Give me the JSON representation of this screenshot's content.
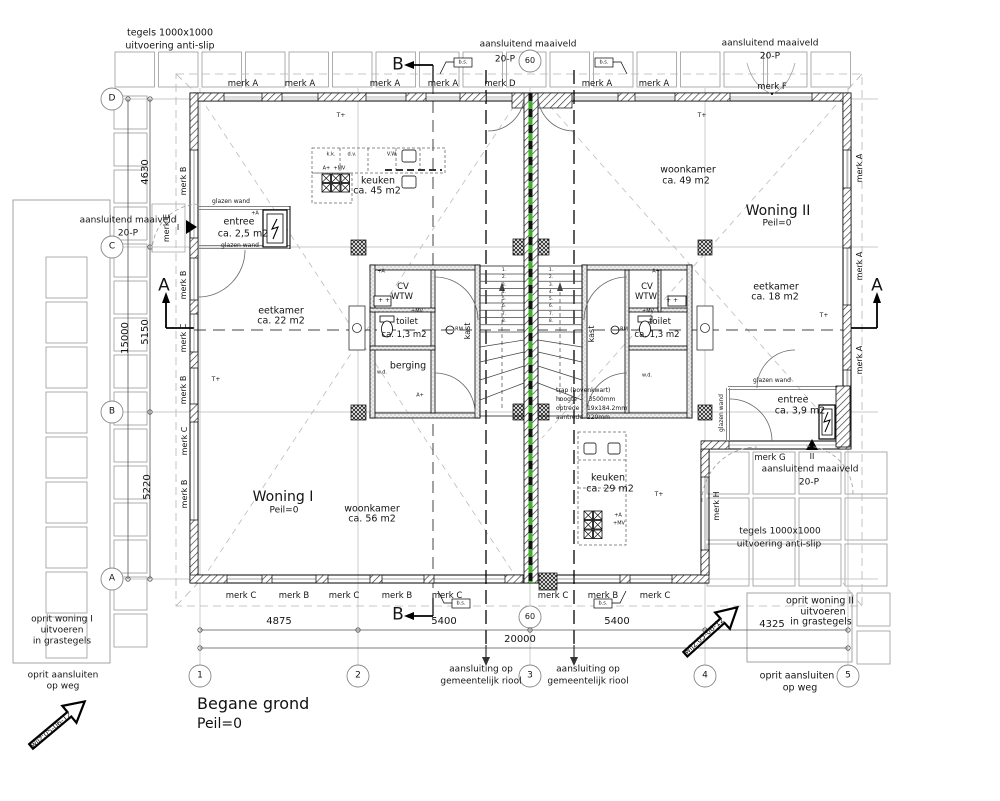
{
  "drawing_title": {
    "name": "Begane grond",
    "level": "Peil=0"
  },
  "colors": {
    "party_wall_green": "#3fae2a",
    "line": "#000000",
    "tile_gray": "#9a9a9a"
  },
  "grid_axes": {
    "columns": [
      {
        "label": "1",
        "x": 200
      },
      {
        "label": "2",
        "x": 358
      },
      {
        "label": "3",
        "x": 530
      },
      {
        "label": "4",
        "x": 705
      },
      {
        "label": "5",
        "x": 848
      }
    ],
    "rows": [
      {
        "label": "D",
        "y": 99
      },
      {
        "label": "C",
        "y": 247
      },
      {
        "label": "B",
        "y": 412
      },
      {
        "label": "A",
        "y": 579
      }
    ]
  },
  "stair_numbers": [
    "1.",
    "2.",
    "3.",
    "4.",
    "5.",
    "6.",
    "7.",
    "8."
  ],
  "labels": [
    {
      "i": "tegels-top-line1",
      "t": "tegels 1000x1000",
      "x": 170,
      "y": 33,
      "s": 9.5
    },
    {
      "i": "tegels-top-line2",
      "t": "uitvoering anti-slip",
      "x": 170,
      "y": 46,
      "s": 9.5
    },
    {
      "i": "maaiveld-top-line1",
      "t": "aansluitend maaiveld",
      "x": 528,
      "y": 45,
      "s": 9
    },
    {
      "i": "maaiveld-top-line2",
      "t": "20-P",
      "x": 505,
      "y": 60,
      "s": 9
    },
    {
      "i": "level-circle-top",
      "t": "60",
      "x": 530,
      "y": 61,
      "s": 8
    },
    {
      "i": "merk-d-label",
      "t": "merk D",
      "x": 500,
      "y": 84,
      "s": 8.5
    },
    {
      "i": "maaiveld-topright-line1",
      "t": "aansluitend maaiveld",
      "x": 770,
      "y": 44,
      "s": 9
    },
    {
      "i": "maaiveld-topright-line2",
      "t": "20-P",
      "x": 770,
      "y": 57,
      "s": 9
    },
    {
      "i": "merk-f-label",
      "t": "merk F",
      "x": 772,
      "y": 87,
      "s": 8.5
    },
    {
      "i": "merk-a-top-1",
      "t": "merk A",
      "x": 243,
      "y": 84,
      "s": 8.5
    },
    {
      "i": "merk-a-top-2",
      "t": "merk A",
      "x": 300,
      "y": 84,
      "s": 8.5
    },
    {
      "i": "merk-a-top-3",
      "t": "merk A",
      "x": 385,
      "y": 84,
      "s": 8.5
    },
    {
      "i": "merk-a-top-4",
      "t": "merk A",
      "x": 443,
      "y": 84,
      "s": 8.5
    },
    {
      "i": "merk-a-top-5",
      "t": "merk A",
      "x": 597,
      "y": 84,
      "s": 8.5
    },
    {
      "i": "merk-a-top-6",
      "t": "merk A",
      "x": 654,
      "y": 84,
      "s": 8.5
    },
    {
      "i": "maaiveld-left-line1",
      "t": "aansluitend maaiveld",
      "x": 128,
      "y": 221,
      "s": 9
    },
    {
      "i": "maaiveld-left-line2",
      "t": "20-P",
      "x": 128,
      "y": 234,
      "s": 9
    },
    {
      "i": "merk-e-label",
      "t": "merk E",
      "x": 167,
      "y": 228,
      "s": 8,
      "r": -90
    },
    {
      "i": "entrance-mark-1",
      "t": "I",
      "x": 178,
      "y": 228,
      "s": 8
    },
    {
      "i": "glazen-wand-1",
      "t": "glazen wand",
      "x": 231,
      "y": 202,
      "s": 6
    },
    {
      "i": "entree1-line1",
      "t": "entree",
      "x": 239,
      "y": 222,
      "s": 9.5
    },
    {
      "i": "entree1-line2",
      "t": "ca. 2,5 m2",
      "x": 243,
      "y": 234,
      "s": 9.5
    },
    {
      "i": "glazen-wand-2",
      "t": "glazen wand",
      "x": 240,
      "y": 246,
      "s": 6
    },
    {
      "i": "keuken1-line1",
      "t": "keuken",
      "x": 378,
      "y": 181,
      "s": 9.5
    },
    {
      "i": "keuken1-line2",
      "t": "ca. 45 m2",
      "x": 377,
      "y": 191,
      "s": 9.5
    },
    {
      "i": "kitchen1-kk",
      "t": "k.k.",
      "x": 331,
      "y": 155,
      "s": 5
    },
    {
      "i": "kitchen1-dv",
      "t": "d.v.",
      "x": 352,
      "y": 155,
      "s": 5
    },
    {
      "i": "kitchen1-vw",
      "t": "V.W.",
      "x": 392,
      "y": 155,
      "s": 5
    },
    {
      "i": "kitchen1-symbols",
      "t": "A+  +MV",
      "x": 334,
      "y": 169,
      "s": 5
    },
    {
      "i": "woonkamer2-line1",
      "t": "woonkamer",
      "x": 688,
      "y": 170,
      "s": 9.5
    },
    {
      "i": "woonkamer2-line2",
      "t": "ca. 49 m2",
      "x": 686,
      "y": 181,
      "s": 9.5
    },
    {
      "i": "woning2-name",
      "t": "Woning II",
      "x": 778,
      "y": 211,
      "s": 14
    },
    {
      "i": "woning2-peil",
      "t": "Peil=0",
      "x": 777,
      "y": 224,
      "s": 9
    },
    {
      "i": "eetkamer1-line1",
      "t": "eetkamer",
      "x": 281,
      "y": 311,
      "s": 9.5
    },
    {
      "i": "eetkamer1-line2",
      "t": "ca. 22 m2",
      "x": 281,
      "y": 321,
      "s": 9.5
    },
    {
      "i": "eetkamer2-line1",
      "t": "eetkamer",
      "x": 776,
      "y": 287,
      "s": 9.5
    },
    {
      "i": "eetkamer2-line2",
      "t": "ca. 18 m2",
      "x": 775,
      "y": 297,
      "s": 9.5
    },
    {
      "i": "cv1-line1",
      "t": "CV",
      "x": 403,
      "y": 287,
      "s": 8.5
    },
    {
      "i": "cv1-line2",
      "t": "WTW",
      "x": 402,
      "y": 297,
      "s": 8.5
    },
    {
      "i": "cv2-line1",
      "t": "CV",
      "x": 647,
      "y": 287,
      "s": 8.5
    },
    {
      "i": "cv2-line2",
      "t": "WTW",
      "x": 646,
      "y": 297,
      "s": 8.5
    },
    {
      "i": "cv1-sink-sym",
      "t": "+ +",
      "x": 384,
      "y": 301,
      "s": 6
    },
    {
      "i": "cv2-sink-sym",
      "t": "+ +",
      "x": 672,
      "y": 301,
      "s": 6
    },
    {
      "i": "cv1-vent",
      "t": "+A",
      "x": 381,
      "y": 272,
      "s": 5
    },
    {
      "i": "cv2-vent",
      "t": "A+",
      "x": 656,
      "y": 272,
      "s": 5
    },
    {
      "i": "toilet1-vent",
      "t": "+MV",
      "x": 417,
      "y": 312,
      "s": 5
    },
    {
      "i": "toilet2-vent",
      "t": "+MV",
      "x": 648,
      "y": 312,
      "s": 5
    },
    {
      "i": "toilet1-line1",
      "t": "toilet",
      "x": 407,
      "y": 322,
      "s": 8.5
    },
    {
      "i": "toilet1-line2",
      "t": "ca. 1,3 m2",
      "x": 404,
      "y": 335,
      "s": 8.5
    },
    {
      "i": "toilet2-line1",
      "t": "toilet",
      "x": 660,
      "y": 322,
      "s": 8.5
    },
    {
      "i": "toilet2-line2",
      "t": "ca. 1,3 m2",
      "x": 657,
      "y": 335,
      "s": 8.5
    },
    {
      "i": "smoke-detector-1",
      "t": "RM",
      "x": 459,
      "y": 330,
      "s": 5
    },
    {
      "i": "smoke-detector-2",
      "t": "RM",
      "x": 624,
      "y": 330,
      "s": 5
    },
    {
      "i": "kast1-label",
      "t": "kast",
      "x": 468,
      "y": 331,
      "s": 8,
      "r": -90
    },
    {
      "i": "kast2-label",
      "t": "kast",
      "x": 592,
      "y": 334,
      "s": 8,
      "r": -90
    },
    {
      "i": "berging-label",
      "t": "berging",
      "x": 408,
      "y": 366,
      "s": 9.5
    },
    {
      "i": "wd1-label",
      "t": "w.d.",
      "x": 382,
      "y": 373,
      "s": 5
    },
    {
      "i": "wd2-label",
      "t": "w.d.",
      "x": 647,
      "y": 376,
      "s": 5
    },
    {
      "i": "berging-vent",
      "t": "A+",
      "x": 420,
      "y": 396,
      "s": 5
    },
    {
      "i": "trap-line1",
      "t": "trap (bovenkwart)",
      "x": 556,
      "y": 391,
      "s": 6,
      "a": "l"
    },
    {
      "i": "trap-line2",
      "t": "hoogte      3500mm",
      "x": 556,
      "y": 400,
      "s": 6,
      "a": "l"
    },
    {
      "i": "trap-line3",
      "t": "optrede    19x184.2mm",
      "x": 556,
      "y": 409,
      "s": 6,
      "a": "l"
    },
    {
      "i": "trap-line4",
      "t": "aantrede  220mm",
      "x": 556,
      "y": 418,
      "s": 6,
      "a": "l"
    },
    {
      "i": "keuken2-line1",
      "t": "keuken",
      "x": 608,
      "y": 478,
      "s": 9.5
    },
    {
      "i": "keuken2-line2",
      "t": "ca. 29 m2",
      "x": 610,
      "y": 489,
      "s": 9.5
    },
    {
      "i": "kitchen2-vent-a",
      "t": "+A",
      "x": 618,
      "y": 516,
      "s": 5
    },
    {
      "i": "kitchen2-vent-mv",
      "t": "+MV",
      "x": 619,
      "y": 524,
      "s": 5
    },
    {
      "i": "woning1-name",
      "t": "Woning I",
      "x": 283,
      "y": 497,
      "s": 14
    },
    {
      "i": "woning1-peil",
      "t": "Peil=0",
      "x": 284,
      "y": 511,
      "s": 9
    },
    {
      "i": "woonkamer1-line1",
      "t": "woonkamer",
      "x": 372,
      "y": 509,
      "s": 9.5
    },
    {
      "i": "woonkamer1-line2",
      "t": "ca. 56 m2",
      "x": 372,
      "y": 519,
      "s": 9.5
    },
    {
      "i": "glazen-wand-3",
      "t": "glazen wand",
      "x": 772,
      "y": 381,
      "s": 6
    },
    {
      "i": "glazen-wand-4",
      "t": "glazen wand",
      "x": 722,
      "y": 413,
      "s": 6,
      "r": -90
    },
    {
      "i": "entree2-line1",
      "t": "entree",
      "x": 793,
      "y": 400,
      "s": 9.5
    },
    {
      "i": "entree2-line2",
      "t": "ca. 3,9 m2",
      "x": 800,
      "y": 411,
      "s": 9.5
    },
    {
      "i": "merk-g-label",
      "t": "merk G",
      "x": 770,
      "y": 458,
      "s": 8.5
    },
    {
      "i": "entrance-mark-2",
      "t": "II",
      "x": 812,
      "y": 457,
      "s": 8
    },
    {
      "i": "maaiveld-br-line1",
      "t": "aansluitend maaiveld",
      "x": 810,
      "y": 470,
      "s": 9
    },
    {
      "i": "maaiveld-br-line2",
      "t": "20-P",
      "x": 809,
      "y": 483,
      "s": 9
    },
    {
      "i": "merk-h-label",
      "t": "merk H",
      "x": 717,
      "y": 506,
      "s": 8,
      "r": -90
    },
    {
      "i": "tegels-br-line1",
      "t": "tegels 1000x1000",
      "x": 780,
      "y": 532,
      "s": 9
    },
    {
      "i": "tegels-br-line2",
      "t": "uitvoering anti-slip",
      "x": 779,
      "y": 545,
      "s": 9
    },
    {
      "i": "thermostat-1",
      "t": "T+",
      "x": 341,
      "y": 116,
      "s": 6
    },
    {
      "i": "thermostat-2",
      "t": "T+",
      "x": 702,
      "y": 116,
      "s": 6
    },
    {
      "i": "thermostat-3",
      "t": "T+",
      "x": 216,
      "y": 380,
      "s": 6
    },
    {
      "i": "thermostat-4",
      "t": "T+",
      "x": 659,
      "y": 495,
      "s": 6
    },
    {
      "i": "thermostat-5",
      "t": "T+",
      "x": 824,
      "y": 316,
      "s": 6
    },
    {
      "i": "merk-left-1",
      "t": "merk B",
      "x": 184,
      "y": 181,
      "s": 8,
      "r": -90
    },
    {
      "i": "merk-left-2",
      "t": "merk B",
      "x": 184,
      "y": 285,
      "s": 8,
      "r": -90
    },
    {
      "i": "merk-left-3",
      "t": "merk C",
      "x": 184,
      "y": 338,
      "s": 8,
      "r": -90
    },
    {
      "i": "merk-left-4",
      "t": "merk B",
      "x": 184,
      "y": 390,
      "s": 8,
      "r": -90
    },
    {
      "i": "merk-left-5",
      "t": "merk C",
      "x": 185,
      "y": 441,
      "s": 8,
      "r": -90
    },
    {
      "i": "merk-left-6",
      "t": "merk B",
      "x": 185,
      "y": 494,
      "s": 8,
      "r": -90
    },
    {
      "i": "merk-right-1",
      "t": "merk A",
      "x": 860,
      "y": 168,
      "s": 8,
      "r": -90
    },
    {
      "i": "merk-right-2",
      "t": "merk A",
      "x": 860,
      "y": 266,
      "s": 8,
      "r": -90
    },
    {
      "i": "merk-right-3",
      "t": "merk A",
      "x": 860,
      "y": 360,
      "s": 8,
      "r": -90
    },
    {
      "i": "merk-bottom-1",
      "t": "merk C",
      "x": 241,
      "y": 596,
      "s": 8.5
    },
    {
      "i": "merk-bottom-2",
      "t": "merk B",
      "x": 294,
      "y": 596,
      "s": 8.5
    },
    {
      "i": "merk-bottom-3",
      "t": "merk C",
      "x": 344,
      "y": 596,
      "s": 8.5
    },
    {
      "i": "merk-bottom-4",
      "t": "merk B",
      "x": 397,
      "y": 596,
      "s": 8.5
    },
    {
      "i": "merk-bottom-5",
      "t": "merk C",
      "x": 447,
      "y": 596,
      "s": 8.5
    },
    {
      "i": "merk-bottom-6",
      "t": "merk C",
      "x": 553,
      "y": 596,
      "s": 8.5
    },
    {
      "i": "merk-bottom-7",
      "t": "merk B",
      "x": 603,
      "y": 596,
      "s": 8.5
    },
    {
      "i": "merk-bottom-8",
      "t": "merk C",
      "x": 655,
      "y": 596,
      "s": 8.5
    },
    {
      "i": "section-b-top",
      "t": "B",
      "x": 398,
      "y": 65,
      "s": 17
    },
    {
      "i": "section-b-bottom",
      "t": "B",
      "x": 398,
      "y": 615,
      "s": 17
    },
    {
      "i": "section-a-left",
      "t": "A",
      "x": 164,
      "y": 286,
      "s": 17
    },
    {
      "i": "section-a-right",
      "t": "A",
      "x": 877,
      "y": 286,
      "s": 17
    },
    {
      "i": "dim-4875",
      "t": "4875",
      "x": 279,
      "y": 622,
      "s": 10
    },
    {
      "i": "dim-5400-a",
      "t": "5400",
      "x": 444,
      "y": 622,
      "s": 10
    },
    {
      "i": "d60-bottom",
      "t": "60",
      "x": 530,
      "y": 617,
      "s": 8
    },
    {
      "i": "dim-5400-b",
      "t": "5400",
      "x": 617,
      "y": 622,
      "s": 10
    },
    {
      "i": "dim-20000",
      "t": "20000",
      "x": 520,
      "y": 640,
      "s": 10
    },
    {
      "i": "dim-4325",
      "t": "4325",
      "x": 772,
      "y": 625,
      "s": 10
    },
    {
      "i": "dim-4630",
      "t": "4630",
      "x": 146,
      "y": 172,
      "s": 10,
      "r": -90
    },
    {
      "i": "dim-15000",
      "t": "15000",
      "x": 126,
      "y": 338,
      "s": 10,
      "r": -90
    },
    {
      "i": "dim-5150",
      "t": "5150",
      "x": 146,
      "y": 332,
      "s": 10,
      "r": -90
    },
    {
      "i": "dim-5220",
      "t": "5220",
      "x": 148,
      "y": 487,
      "s": 10,
      "r": -90
    },
    {
      "i": "grid-col-1",
      "t": "1",
      "x": 200,
      "y": 676,
      "s": 9
    },
    {
      "i": "grid-col-2",
      "t": "2",
      "x": 358,
      "y": 676,
      "s": 9
    },
    {
      "i": "grid-col-3",
      "t": "3",
      "x": 530,
      "y": 676,
      "s": 9
    },
    {
      "i": "grid-col-4",
      "t": "4",
      "x": 705,
      "y": 676,
      "s": 9
    },
    {
      "i": "grid-col-5",
      "t": "5",
      "x": 848,
      "y": 676,
      "s": 9
    },
    {
      "i": "grid-row-d",
      "t": "D",
      "x": 112,
      "y": 99,
      "s": 9
    },
    {
      "i": "grid-row-c",
      "t": "C",
      "x": 112,
      "y": 247,
      "s": 9
    },
    {
      "i": "grid-row-b",
      "t": "B",
      "x": 112,
      "y": 412,
      "s": 9
    },
    {
      "i": "grid-row-a",
      "t": "A",
      "x": 112,
      "y": 579,
      "s": 9
    },
    {
      "i": "riool1-line1",
      "t": "aansluiting op",
      "x": 481,
      "y": 670,
      "s": 9
    },
    {
      "i": "riool1-line2",
      "t": "gemeentelijk riool",
      "x": 481,
      "y": 682,
      "s": 9
    },
    {
      "i": "riool2-line1",
      "t": "aansluiting op",
      "x": 588,
      "y": 670,
      "s": 9
    },
    {
      "i": "riool2-line2",
      "t": "gemeentelijk riool",
      "x": 588,
      "y": 682,
      "s": 9
    },
    {
      "i": "oprit1-line1",
      "t": "oprit woning I",
      "x": 62,
      "y": 620,
      "s": 9
    },
    {
      "i": "oprit1-line2",
      "t": "uitvoeren",
      "x": 62,
      "y": 631,
      "s": 9
    },
    {
      "i": "oprit1-line3",
      "t": "in grastegels",
      "x": 62,
      "y": 642,
      "s": 9
    },
    {
      "i": "opritweg1-line1",
      "t": "oprit aansluiten",
      "x": 63,
      "y": 676,
      "s": 9
    },
    {
      "i": "opritweg1-line2",
      "t": "op weg",
      "x": 63,
      "y": 687,
      "s": 9
    },
    {
      "i": "oprit2-line1",
      "t": "oprit woning II",
      "x": 820,
      "y": 601,
      "s": 9.5
    },
    {
      "i": "oprit2-line2",
      "t": "uitvoeren",
      "x": 823,
      "y": 612,
      "s": 9.5
    },
    {
      "i": "oprit2-line3",
      "t": "in grastegels",
      "x": 821,
      "y": 622,
      "s": 9.5
    },
    {
      "i": "opritweg2-line1",
      "t": "oprit aansluiten",
      "x": 797,
      "y": 676,
      "s": 9.5
    },
    {
      "i": "opritweg2-line2",
      "t": "op weg",
      "x": 800,
      "y": 688,
      "s": 9.5
    },
    {
      "i": "wijz-left",
      "t": "wijz:05-06-12",
      "x": 51,
      "y": 730,
      "s": 7.5,
      "r": -40
    },
    {
      "i": "wijz-right",
      "t": "wijz:05-06-12",
      "x": 704,
      "y": 636,
      "s": 7.5,
      "r": -42
    },
    {
      "i": "bs-box-1",
      "t": "b.s.",
      "x": 463,
      "y": 63,
      "s": 5
    },
    {
      "i": "bs-box-2",
      "t": "b.s.",
      "x": 604,
      "y": 63,
      "s": 5
    },
    {
      "i": "bs-box-3",
      "t": "b.s.",
      "x": 461,
      "y": 604,
      "s": 5
    },
    {
      "i": "bs-box-4",
      "t": "b.s.",
      "x": 603,
      "y": 604,
      "s": 5
    },
    {
      "i": "entree1-vent",
      "t": "+A",
      "x": 255,
      "y": 214,
      "s": 5
    }
  ]
}
